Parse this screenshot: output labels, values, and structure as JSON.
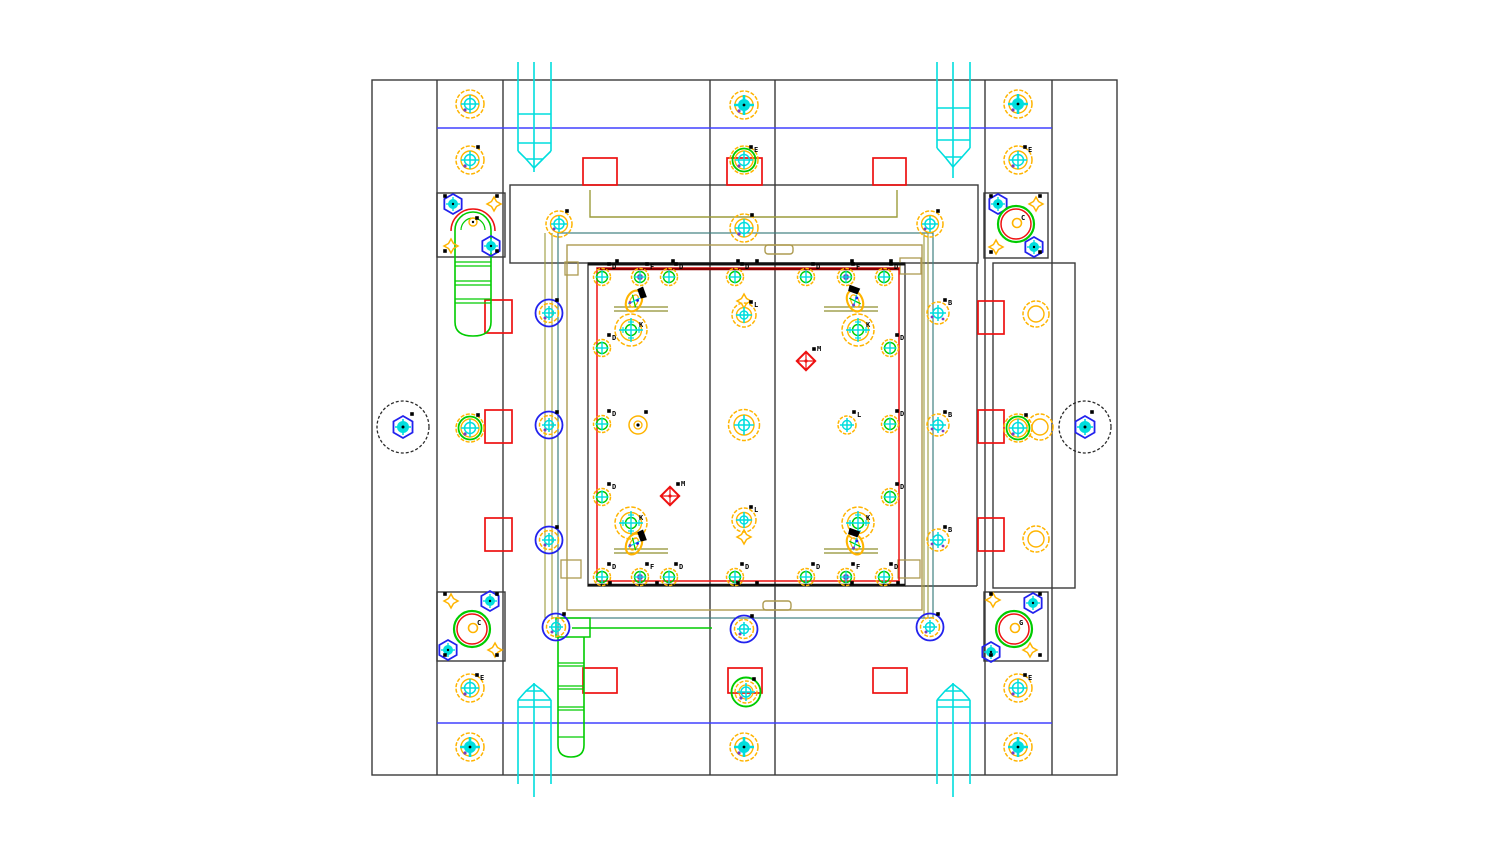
{
  "title": "Injection mold base assembly drawing - plan view",
  "canvas": {
    "w": 1490,
    "h": 856,
    "bg": "#ffffff"
  },
  "palette": {
    "frame": "#3a3a3a",
    "dark": "#111111",
    "red": "#ee1111",
    "darkred": "#8b0000",
    "blue": "#2222ee",
    "blueline": "#4040ff",
    "cyan": "#00dede",
    "yellow": "#ffb400",
    "green": "#00cc00",
    "olive": "#9c9c3c",
    "khaki": "#ad9b50",
    "teal": "#3f8080",
    "purple": "#7a3fbf",
    "black": "#000000",
    "gray": "#2a2a2a"
  },
  "frame_rects": [
    [
      372,
      80,
      745,
      695
    ],
    [
      510,
      185,
      468,
      78
    ],
    [
      588,
      263,
      317,
      323
    ],
    [
      993,
      263,
      82,
      325
    ],
    [
      437,
      193,
      68,
      64
    ],
    [
      984,
      193,
      64,
      65
    ],
    [
      437,
      592,
      68,
      69
    ],
    [
      984,
      592,
      64,
      69
    ]
  ],
  "frame_lines": [
    [
      437,
      80,
      437,
      775
    ],
    [
      503,
      80,
      503,
      775
    ],
    [
      710,
      80,
      710,
      775
    ],
    [
      775,
      80,
      775,
      775
    ],
    [
      985,
      80,
      985,
      775
    ],
    [
      1052,
      80,
      1052,
      775
    ],
    [
      977,
      263,
      977,
      586
    ],
    [
      905,
      586,
      977,
      586
    ]
  ],
  "blue_lines": [
    [
      437,
      128,
      1052,
      128
    ],
    [
      437,
      723,
      1052,
      723
    ]
  ],
  "teal_rect": [
    558,
    233,
    375,
    385
  ],
  "teal_lines": [
    [
      558,
      618,
      558,
      636
    ]
  ],
  "green_lines": [
    [
      572,
      628,
      712,
      628
    ]
  ],
  "cavity": {
    "dark_top": [
      588,
      264,
      905,
      264
    ],
    "red_rect": [
      597,
      268,
      302,
      313
    ],
    "darkred_top": [
      597,
      269,
      899,
      269
    ],
    "black_bottom": [
      588,
      585,
      905,
      585
    ]
  },
  "olive": {
    "rect": [
      567,
      245,
      355,
      365
    ],
    "channel": [
      [
        590,
        190
      ],
      [
        590,
        217
      ],
      [
        897,
        217
      ],
      [
        897,
        190
      ]
    ],
    "verticals": [
      [
        545,
        233,
        545,
        618
      ],
      [
        552,
        233,
        552,
        618
      ],
      [
        924,
        233,
        924,
        618
      ],
      [
        928,
        233,
        928,
        618
      ]
    ],
    "pairs": [
      [
        614,
        307,
        668,
        307
      ],
      [
        614,
        311,
        668,
        311
      ],
      [
        824,
        307,
        878,
        307
      ],
      [
        824,
        311,
        878,
        311
      ],
      [
        614,
        549,
        668,
        549
      ],
      [
        614,
        553,
        668,
        553
      ],
      [
        824,
        549,
        878,
        549
      ],
      [
        824,
        553,
        878,
        553
      ]
    ],
    "tabs": [
      [
        765,
        245,
        28,
        9
      ],
      [
        763,
        601,
        28,
        9
      ]
    ],
    "jogs": [
      [
        565,
        262,
        13,
        13
      ],
      [
        900,
        258,
        21,
        16
      ],
      [
        561,
        560,
        20,
        18
      ],
      [
        898,
        560,
        22,
        18
      ]
    ]
  },
  "red_rects": [
    [
      583,
      158,
      34,
      27
    ],
    [
      727,
      158,
      35,
      27
    ],
    [
      873,
      158,
      33,
      27
    ],
    [
      485,
      300,
      27,
      33
    ],
    [
      485,
      410,
      27,
      33
    ],
    [
      485,
      518,
      27,
      33
    ],
    [
      978,
      301,
      26,
      33
    ],
    [
      978,
      410,
      26,
      33
    ],
    [
      978,
      518,
      26,
      33
    ],
    [
      583,
      668,
      34,
      25
    ],
    [
      728,
      668,
      34,
      25
    ],
    [
      873,
      668,
      34,
      25
    ]
  ],
  "bolts": [
    {
      "x": 470,
      "y": 104,
      "t": "std"
    },
    {
      "x": 470,
      "y": 160,
      "t": "std",
      "tick": 1
    },
    {
      "x": 470,
      "y": 428,
      "t": "green",
      "tick": 1
    },
    {
      "x": 470,
      "y": 688,
      "t": "std",
      "lb": "E"
    },
    {
      "x": 470,
      "y": 747,
      "t": "target"
    },
    {
      "x": 744,
      "y": 105,
      "t": "target"
    },
    {
      "x": 744,
      "y": 160,
      "t": "green",
      "lb": "E"
    },
    {
      "x": 744,
      "y": 228,
      "t": "std",
      "tick": 1
    },
    {
      "x": 744,
      "y": 747,
      "t": "target"
    },
    {
      "x": 1018,
      "y": 104,
      "t": "target"
    },
    {
      "x": 1018,
      "y": 160,
      "t": "std",
      "lb": "E"
    },
    {
      "x": 1018,
      "y": 428,
      "t": "green",
      "tick": 1
    },
    {
      "x": 1018,
      "y": 688,
      "t": "std",
      "lb": "E"
    },
    {
      "x": 1018,
      "y": 747,
      "t": "target"
    },
    {
      "x": 559,
      "y": 224,
      "t": "bar",
      "tick": 1
    },
    {
      "x": 930,
      "y": 224,
      "t": "bar",
      "tick": 1
    },
    {
      "x": 746,
      "y": 692,
      "t": "green2",
      "tick": 1
    },
    {
      "x": 549,
      "y": 313,
      "t": "blue",
      "tick": 1
    },
    {
      "x": 549,
      "y": 425,
      "t": "blue",
      "tick": 1
    },
    {
      "x": 549,
      "y": 540,
      "t": "blue",
      "tick": 1
    },
    {
      "x": 556,
      "y": 627,
      "t": "blue",
      "tick": 1
    },
    {
      "x": 744,
      "y": 629,
      "t": "blue",
      "tick": 1
    },
    {
      "x": 930,
      "y": 627,
      "t": "blue",
      "tick": 1
    },
    {
      "x": 938,
      "y": 313,
      "t": "b",
      "lb": "B"
    },
    {
      "x": 938,
      "y": 425,
      "t": "b",
      "lb": "B"
    },
    {
      "x": 938,
      "y": 540,
      "t": "b",
      "lb": "B"
    },
    {
      "x": 638,
      "y": 425,
      "t": "small",
      "tick": 1
    },
    {
      "x": 847,
      "y": 425,
      "t": "cyanx",
      "lb": "L"
    },
    {
      "x": 602,
      "y": 277,
      "t": "d",
      "lb": "D"
    },
    {
      "x": 640,
      "y": 277,
      "t": "f",
      "lb": "F"
    },
    {
      "x": 669,
      "y": 277,
      "t": "d",
      "lb": "D"
    },
    {
      "x": 735,
      "y": 277,
      "t": "d",
      "lb": "D"
    },
    {
      "x": 806,
      "y": 277,
      "t": "d",
      "lb": "D"
    },
    {
      "x": 846,
      "y": 277,
      "t": "f",
      "lb": "F"
    },
    {
      "x": 884,
      "y": 277,
      "t": "d",
      "lb": "D"
    },
    {
      "x": 602,
      "y": 577,
      "t": "d",
      "lb": "D"
    },
    {
      "x": 640,
      "y": 577,
      "t": "f",
      "lb": "F"
    },
    {
      "x": 669,
      "y": 577,
      "t": "d",
      "lb": "D"
    },
    {
      "x": 735,
      "y": 577,
      "t": "d",
      "lb": "D"
    },
    {
      "x": 806,
      "y": 577,
      "t": "d",
      "lb": "D"
    },
    {
      "x": 846,
      "y": 577,
      "t": "f",
      "lb": "F"
    },
    {
      "x": 884,
      "y": 577,
      "t": "d",
      "lb": "D"
    },
    {
      "x": 602,
      "y": 348,
      "t": "d",
      "lb": "D"
    },
    {
      "x": 602,
      "y": 424,
      "t": "d",
      "lb": "D"
    },
    {
      "x": 602,
      "y": 497,
      "t": "d",
      "lb": "D"
    },
    {
      "x": 890,
      "y": 348,
      "t": "d",
      "lb": "D"
    },
    {
      "x": 890,
      "y": 424,
      "t": "d",
      "lb": "D"
    },
    {
      "x": 890,
      "y": 497,
      "t": "d",
      "lb": "D"
    },
    {
      "x": 744,
      "y": 315,
      "t": "flower_s",
      "lb": "L"
    },
    {
      "x": 744,
      "y": 425,
      "t": "flower_m"
    },
    {
      "x": 744,
      "y": 520,
      "t": "flower_s",
      "lb": "L"
    }
  ],
  "k_flowers": [
    [
      631,
      330,
      "K"
    ],
    [
      858,
      330,
      "K"
    ],
    [
      631,
      523,
      "K"
    ],
    [
      858,
      523,
      "K"
    ]
  ],
  "tilted_bolts": [
    [
      634,
      301,
      25
    ],
    [
      855,
      301,
      -25
    ],
    [
      634,
      544,
      25
    ],
    [
      855,
      544,
      -25
    ]
  ],
  "red_diamonds": [
    [
      806,
      361,
      "M"
    ],
    [
      670,
      496,
      "M"
    ]
  ],
  "hex_marks": [
    [
      453,
      204
    ],
    [
      491,
      246
    ],
    [
      998,
      204
    ],
    [
      1034,
      247
    ],
    [
      490,
      601
    ],
    [
      448,
      650
    ],
    [
      1033,
      603
    ],
    [
      991,
      652
    ]
  ],
  "diamond_marks": [
    [
      494,
      204
    ],
    [
      451,
      246
    ],
    [
      1036,
      204
    ],
    [
      996,
      247
    ],
    [
      451,
      601
    ],
    [
      495,
      650
    ],
    [
      993,
      600
    ],
    [
      1030,
      650
    ],
    [
      744,
      301
    ],
    [
      744,
      537
    ]
  ],
  "box_circles": [
    [
      1016,
      224,
      "C"
    ],
    [
      472,
      629,
      "C"
    ],
    [
      1014,
      629,
      "G"
    ]
  ],
  "black_circles": [
    [
      403,
      427
    ],
    [
      1085,
      427
    ]
  ],
  "support_rings": [
    [
      1036,
      314
    ],
    [
      1036,
      539
    ],
    [
      1040,
      427
    ]
  ],
  "clamp": {
    "body": "M455,322 L455,230 A18,18 0 0 1 491,230 L491,322",
    "bottom": "M455,322 Q455,336 473,336 Q491,336 491,322",
    "inner_arch": "M461,230 A12,12 0 0 1 485,230",
    "red_arc": "M451,231 A22,22 0 0 1 495,231",
    "rungs": [
      262,
      266,
      281,
      285,
      299,
      303
    ],
    "rung_x": [
      455,
      491
    ],
    "pin": [
      473,
      222
    ]
  },
  "ladder": {
    "top_box": [
      556,
      618,
      34,
      19
    ],
    "body": "M558,637 L558,745 Q558,757 571,757 Q584,757 584,745 L584,637",
    "rungs": [
      663,
      666,
      686,
      689,
      707,
      710,
      737
    ],
    "rung_x": [
      558,
      584
    ]
  },
  "tie_bars": [
    {
      "lines": [
        [
          518,
          62,
          518,
          151
        ],
        [
          551,
          62,
          551,
          151
        ],
        [
          534,
          62,
          534,
          172
        ],
        [
          518,
          114,
          551,
          114
        ],
        [
          518,
          143,
          551,
          143
        ]
      ],
      "polys": [
        [
          [
            518,
            151
          ],
          [
            526,
            159
          ],
          [
            543,
            159
          ],
          [
            551,
            151
          ]
        ],
        [
          [
            526,
            159
          ],
          [
            534,
            168
          ],
          [
            543,
            159
          ]
        ]
      ]
    },
    {
      "lines": [
        [
          937,
          62,
          937,
          148
        ],
        [
          970,
          62,
          970,
          148
        ],
        [
          953,
          62,
          953,
          178
        ],
        [
          937,
          108,
          970,
          108
        ],
        [
          937,
          140,
          970,
          140
        ]
      ],
      "polys": [
        [
          [
            937,
            148
          ],
          [
            945,
            157
          ],
          [
            962,
            157
          ],
          [
            970,
            148
          ]
        ],
        [
          [
            945,
            157
          ],
          [
            953,
            167
          ],
          [
            962,
            157
          ]
        ]
      ]
    },
    {
      "lines": [
        [
          518,
          700,
          518,
          784
        ],
        [
          551,
          700,
          551,
          784
        ],
        [
          534,
          683,
          534,
          797
        ],
        [
          518,
          707,
          551,
          707
        ],
        [
          518,
          700,
          551,
          700
        ]
      ],
      "polys": [
        [
          [
            518,
            700
          ],
          [
            526,
            691
          ],
          [
            543,
            691
          ],
          [
            551,
            700
          ]
        ],
        [
          [
            526,
            691
          ],
          [
            534,
            684
          ],
          [
            543,
            691
          ]
        ]
      ]
    },
    {
      "lines": [
        [
          937,
          700,
          937,
          784
        ],
        [
          970,
          700,
          970,
          784
        ],
        [
          953,
          683,
          953,
          797
        ],
        [
          937,
          707,
          970,
          707
        ],
        [
          937,
          700,
          970,
          700
        ]
      ],
      "polys": [
        [
          [
            937,
            700
          ],
          [
            945,
            691
          ],
          [
            962,
            691
          ],
          [
            970,
            700
          ]
        ],
        [
          [
            945,
            691
          ],
          [
            953,
            684
          ],
          [
            962,
            691
          ]
        ]
      ]
    }
  ],
  "ticks": [
    [
      617,
      261
    ],
    [
      673,
      261
    ],
    [
      738,
      261
    ],
    [
      757,
      261
    ],
    [
      852,
      261
    ],
    [
      891,
      261
    ],
    [
      610,
      583
    ],
    [
      657,
      583
    ],
    [
      738,
      583
    ],
    [
      757,
      583
    ],
    [
      852,
      583
    ],
    [
      898,
      583
    ],
    [
      445,
      196
    ],
    [
      497,
      196
    ],
    [
      445,
      251
    ],
    [
      497,
      251
    ],
    [
      991,
      196
    ],
    [
      1040,
      196
    ],
    [
      991,
      252
    ],
    [
      1040,
      252
    ],
    [
      445,
      594
    ],
    [
      497,
      594
    ],
    [
      445,
      655
    ],
    [
      497,
      655
    ],
    [
      991,
      594
    ],
    [
      1040,
      594
    ],
    [
      991,
      655
    ],
    [
      1040,
      655
    ],
    [
      412,
      414
    ],
    [
      1092,
      412
    ],
    [
      477,
      218
    ]
  ]
}
